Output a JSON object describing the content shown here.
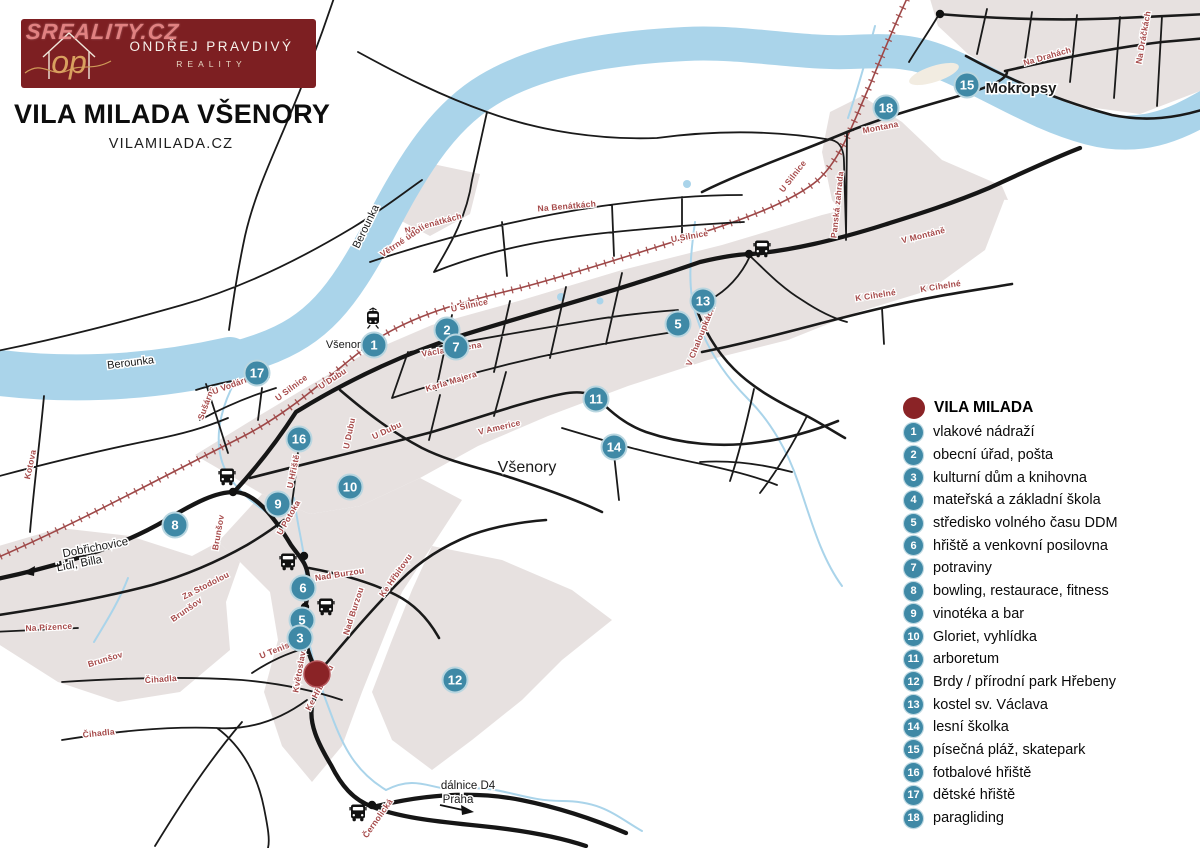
{
  "watermark": "SREALITY.CZ",
  "logo": {
    "monogram": "op",
    "name": "ONDŘEJ PRAVDIVÝ",
    "tagline": "REALITY"
  },
  "header": {
    "title": "VILA MILADA VŠENORY",
    "subtitle": "VILAMILADA.CZ"
  },
  "legend": {
    "title": "VILA MILADA",
    "items": [
      {
        "n": "1",
        "label": "vlakové nádraží"
      },
      {
        "n": "2",
        "label": "obecní úřad, pošta"
      },
      {
        "n": "3",
        "label": "kulturní dům a knihovna"
      },
      {
        "n": "4",
        "label": "mateřská a základní škola"
      },
      {
        "n": "5",
        "label": "středisko volného času DDM"
      },
      {
        "n": "6",
        "label": "hřiště a venkovní posilovna"
      },
      {
        "n": "7",
        "label": "potraviny"
      },
      {
        "n": "8",
        "label": "bowling, restaurace, fitness"
      },
      {
        "n": "9",
        "label": "vinotéka a bar"
      },
      {
        "n": "10",
        "label": "Gloriet, vyhlídka"
      },
      {
        "n": "11",
        "label": "arboretum"
      },
      {
        "n": "12",
        "label": "Brdy / přírodní park Hřebeny"
      },
      {
        "n": "13",
        "label": "kostel sv. Václava"
      },
      {
        "n": "14",
        "label": "lesní školka"
      },
      {
        "n": "15",
        "label": "písečná pláž, skatepark"
      },
      {
        "n": "16",
        "label": "fotbalové hřiště"
      },
      {
        "n": "17",
        "label": "dětské hřiště"
      },
      {
        "n": "18",
        "label": "paragliding"
      }
    ]
  },
  "map": {
    "markers": [
      {
        "n": "1",
        "x": 374,
        "y": 345
      },
      {
        "n": "2",
        "x": 447,
        "y": 330
      },
      {
        "n": "7",
        "x": 456,
        "y": 347
      },
      {
        "n": "13",
        "x": 703,
        "y": 301
      },
      {
        "n": "5",
        "x": 678,
        "y": 324
      },
      {
        "n": "11",
        "x": 596,
        "y": 399
      },
      {
        "n": "14",
        "x": 614,
        "y": 447
      },
      {
        "n": "17",
        "x": 257,
        "y": 373
      },
      {
        "n": "16",
        "x": 299,
        "y": 439
      },
      {
        "n": "10",
        "x": 350,
        "y": 487
      },
      {
        "n": "9",
        "x": 278,
        "y": 504
      },
      {
        "n": "8",
        "x": 175,
        "y": 525
      },
      {
        "n": "6",
        "x": 303,
        "y": 588
      },
      {
        "n": "5",
        "x": 302,
        "y": 620
      },
      {
        "n": "3",
        "x": 300,
        "y": 638
      },
      {
        "n": "12",
        "x": 455,
        "y": 680
      },
      {
        "n": "15",
        "x": 967,
        "y": 85
      },
      {
        "n": "18",
        "x": 886,
        "y": 108
      }
    ],
    "vila_marker": {
      "x": 317,
      "y": 674
    },
    "place_labels": [
      {
        "text": "Všenory",
        "x": 527,
        "y": 472,
        "size": 16,
        "weight": "normal",
        "color": "#1a1a1a",
        "rot": 0
      },
      {
        "text": "Mokropsy",
        "x": 1021,
        "y": 93,
        "size": 15,
        "weight": "bold",
        "color": "#111",
        "rot": 0
      },
      {
        "text": "Všenory",
        "x": 346,
        "y": 348,
        "size": 11,
        "weight": "normal",
        "color": "#1a1a1a",
        "rot": 0
      },
      {
        "text": "Berounka",
        "x": 131,
        "y": 366,
        "size": 11,
        "weight": "normal",
        "color": "#647f8e",
        "rot": -7
      },
      {
        "text": "Berounka",
        "x": 369,
        "y": 228,
        "size": 11,
        "weight": "normal",
        "color": "#647f8e",
        "rot": -64
      },
      {
        "text": "Dobřichovice",
        "x": 96,
        "y": 551,
        "size": 11.5,
        "weight": "normal",
        "color": "#1a1a1a",
        "rot": -11
      },
      {
        "text": "Lidl, Billa",
        "x": 80,
        "y": 567,
        "size": 11.5,
        "weight": "normal",
        "color": "#1a1a1a",
        "rot": -11
      },
      {
        "text": "dálnice D4",
        "x": 468,
        "y": 789,
        "size": 11.5,
        "weight": "normal",
        "color": "#1a1a1a",
        "rot": 0
      },
      {
        "text": "Praha",
        "x": 458,
        "y": 803,
        "size": 11.5,
        "weight": "normal",
        "color": "#1a1a1a",
        "rot": 0
      }
    ],
    "street_labels": [
      {
        "t": "U Silnice",
        "x": 293,
        "y": 390,
        "r": -37
      },
      {
        "t": "U Silnice",
        "x": 470,
        "y": 308,
        "r": -12
      },
      {
        "t": "U Silnice",
        "x": 690,
        "y": 239,
        "r": -10
      },
      {
        "t": "U Silnice",
        "x": 795,
        "y": 178,
        "r": -52
      },
      {
        "t": "Na Benátkách",
        "x": 434,
        "y": 226,
        "r": -15
      },
      {
        "t": "Na Benátkách",
        "x": 567,
        "y": 209,
        "r": -5
      },
      {
        "t": "Václava Křena",
        "x": 452,
        "y": 352,
        "r": -9
      },
      {
        "t": "Karla Majera",
        "x": 452,
        "y": 384,
        "r": -17
      },
      {
        "t": "V Americe",
        "x": 500,
        "y": 430,
        "r": -13
      },
      {
        "t": "U Dubu",
        "x": 334,
        "y": 381,
        "r": -33
      },
      {
        "t": "U Dubu",
        "x": 352,
        "y": 434,
        "r": -78
      },
      {
        "t": "U Dubu",
        "x": 388,
        "y": 433,
        "r": -25
      },
      {
        "t": "U Hřiště",
        "x": 296,
        "y": 472,
        "r": -78
      },
      {
        "t": "U Potoka",
        "x": 291,
        "y": 519,
        "r": -60
      },
      {
        "t": "Nad Burzou",
        "x": 340,
        "y": 577,
        "r": -9
      },
      {
        "t": "Nad Burzou",
        "x": 356,
        "y": 612,
        "r": -72
      },
      {
        "t": "Ke Hřbitovu",
        "x": 398,
        "y": 577,
        "r": -55
      },
      {
        "t": "Ke Hřbitovu",
        "x": 322,
        "y": 689,
        "r": -62
      },
      {
        "t": "Květoslava Mašity",
        "x": 305,
        "y": 655,
        "r": -80
      },
      {
        "t": "U Tenisu",
        "x": 278,
        "y": 652,
        "r": -22
      },
      {
        "t": "Brunšov",
        "x": 221,
        "y": 533,
        "r": -80
      },
      {
        "t": "Brunšov",
        "x": 188,
        "y": 612,
        "r": -35
      },
      {
        "t": "Brunšov",
        "x": 106,
        "y": 662,
        "r": -17
      },
      {
        "t": "Za Stodolou",
        "x": 207,
        "y": 588,
        "r": -27
      },
      {
        "t": "Čihadla",
        "x": 161,
        "y": 682,
        "r": -4
      },
      {
        "t": "Čihadla",
        "x": 99,
        "y": 736,
        "r": -6
      },
      {
        "t": "Na Pízence",
        "x": 49,
        "y": 630,
        "r": -3
      },
      {
        "t": "Kotova",
        "x": 33,
        "y": 465,
        "r": -78
      },
      {
        "t": "Sušárna",
        "x": 209,
        "y": 404,
        "r": -70
      },
      {
        "t": "U Vodárny",
        "x": 234,
        "y": 387,
        "r": -20
      },
      {
        "t": "Montana",
        "x": 881,
        "y": 130,
        "r": -11
      },
      {
        "t": "V Montáně",
        "x": 924,
        "y": 238,
        "r": -14
      },
      {
        "t": "K Cihelné",
        "x": 876,
        "y": 298,
        "r": -9
      },
      {
        "t": "K Cihelné",
        "x": 941,
        "y": 289,
        "r": -9
      },
      {
        "t": "V Chaloupkách",
        "x": 703,
        "y": 337,
        "r": -68
      },
      {
        "t": "Panská zahrada",
        "x": 840,
        "y": 205,
        "r": -84
      },
      {
        "t": "Na Drahách",
        "x": 1048,
        "y": 59,
        "r": -16
      },
      {
        "t": "Na Dráčkách",
        "x": 1146,
        "y": 38,
        "r": -80
      },
      {
        "t": "Černolická",
        "x": 380,
        "y": 820,
        "r": -55
      },
      {
        "t": "Větrné údolí",
        "x": 404,
        "y": 243,
        "r": -34
      }
    ],
    "transit_icons": [
      {
        "type": "bus",
        "x": 227,
        "y": 477
      },
      {
        "type": "bus",
        "x": 288,
        "y": 562
      },
      {
        "type": "bus",
        "x": 326,
        "y": 607
      },
      {
        "type": "bus",
        "x": 762,
        "y": 249
      },
      {
        "type": "bus",
        "x": 358,
        "y": 813
      },
      {
        "type": "train",
        "x": 373,
        "y": 320
      }
    ],
    "junction_dots": [
      [
        233,
        492
      ],
      [
        304,
        556
      ],
      [
        305,
        607
      ],
      [
        749,
        254
      ],
      [
        372,
        805
      ],
      [
        940,
        14
      ]
    ]
  },
  "theme": {
    "river": "#aad4ea",
    "urban": "#e7e1e0",
    "road": "#1a1a1a",
    "railway": "#9e4747",
    "street_label": "#a64a4a",
    "marker": "#3f89a6",
    "vila": "#8a2326",
    "logo_bg": "#7d1f22",
    "gold": "#cf9a58",
    "watermark": "#ef8f8f"
  }
}
